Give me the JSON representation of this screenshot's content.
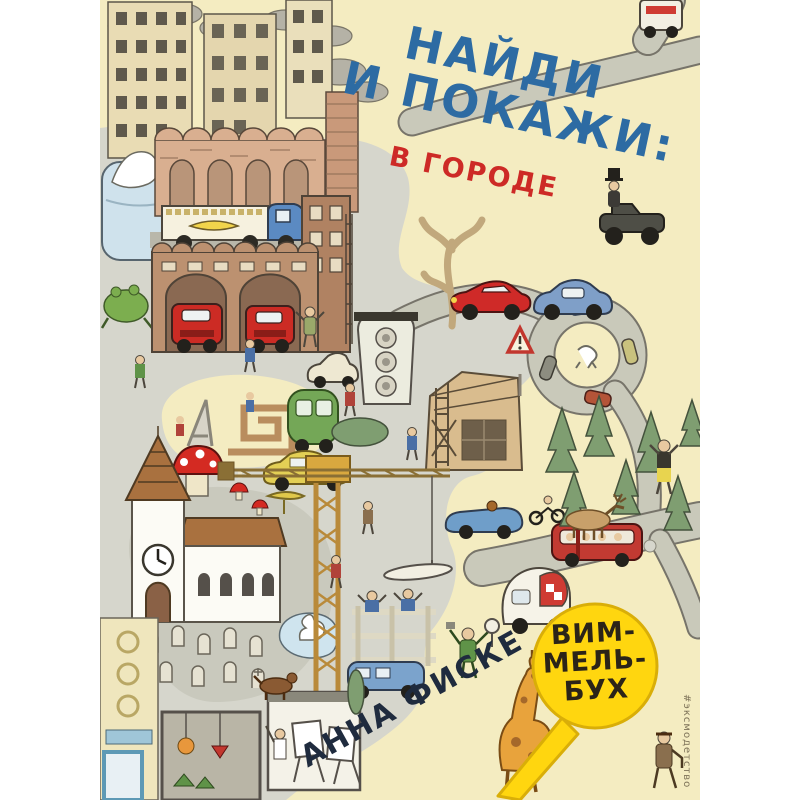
{
  "cover": {
    "title_lines": [
      "НАЙДИ",
      "И ПОКАЖИ:"
    ],
    "subtitle": "В ГОРОДЕ",
    "author": "АННА ФИСКЕ",
    "series_badge_lines": [
      "ВИМ-",
      "МЕЛЬ-",
      "БУХ"
    ],
    "hashtag": "#эксмодетство",
    "colors": {
      "title_blue": "#2d6ba3",
      "subtitle_red": "#cd2a26",
      "author_navy": "#1f2b3e",
      "badge_yellow": "#ffd60f",
      "badge_text": "#2b2418",
      "background_cream": "#f4ecc1",
      "pavement_grey": "#d6d6cc",
      "fire_truck_red": "#cc2b24"
    }
  }
}
